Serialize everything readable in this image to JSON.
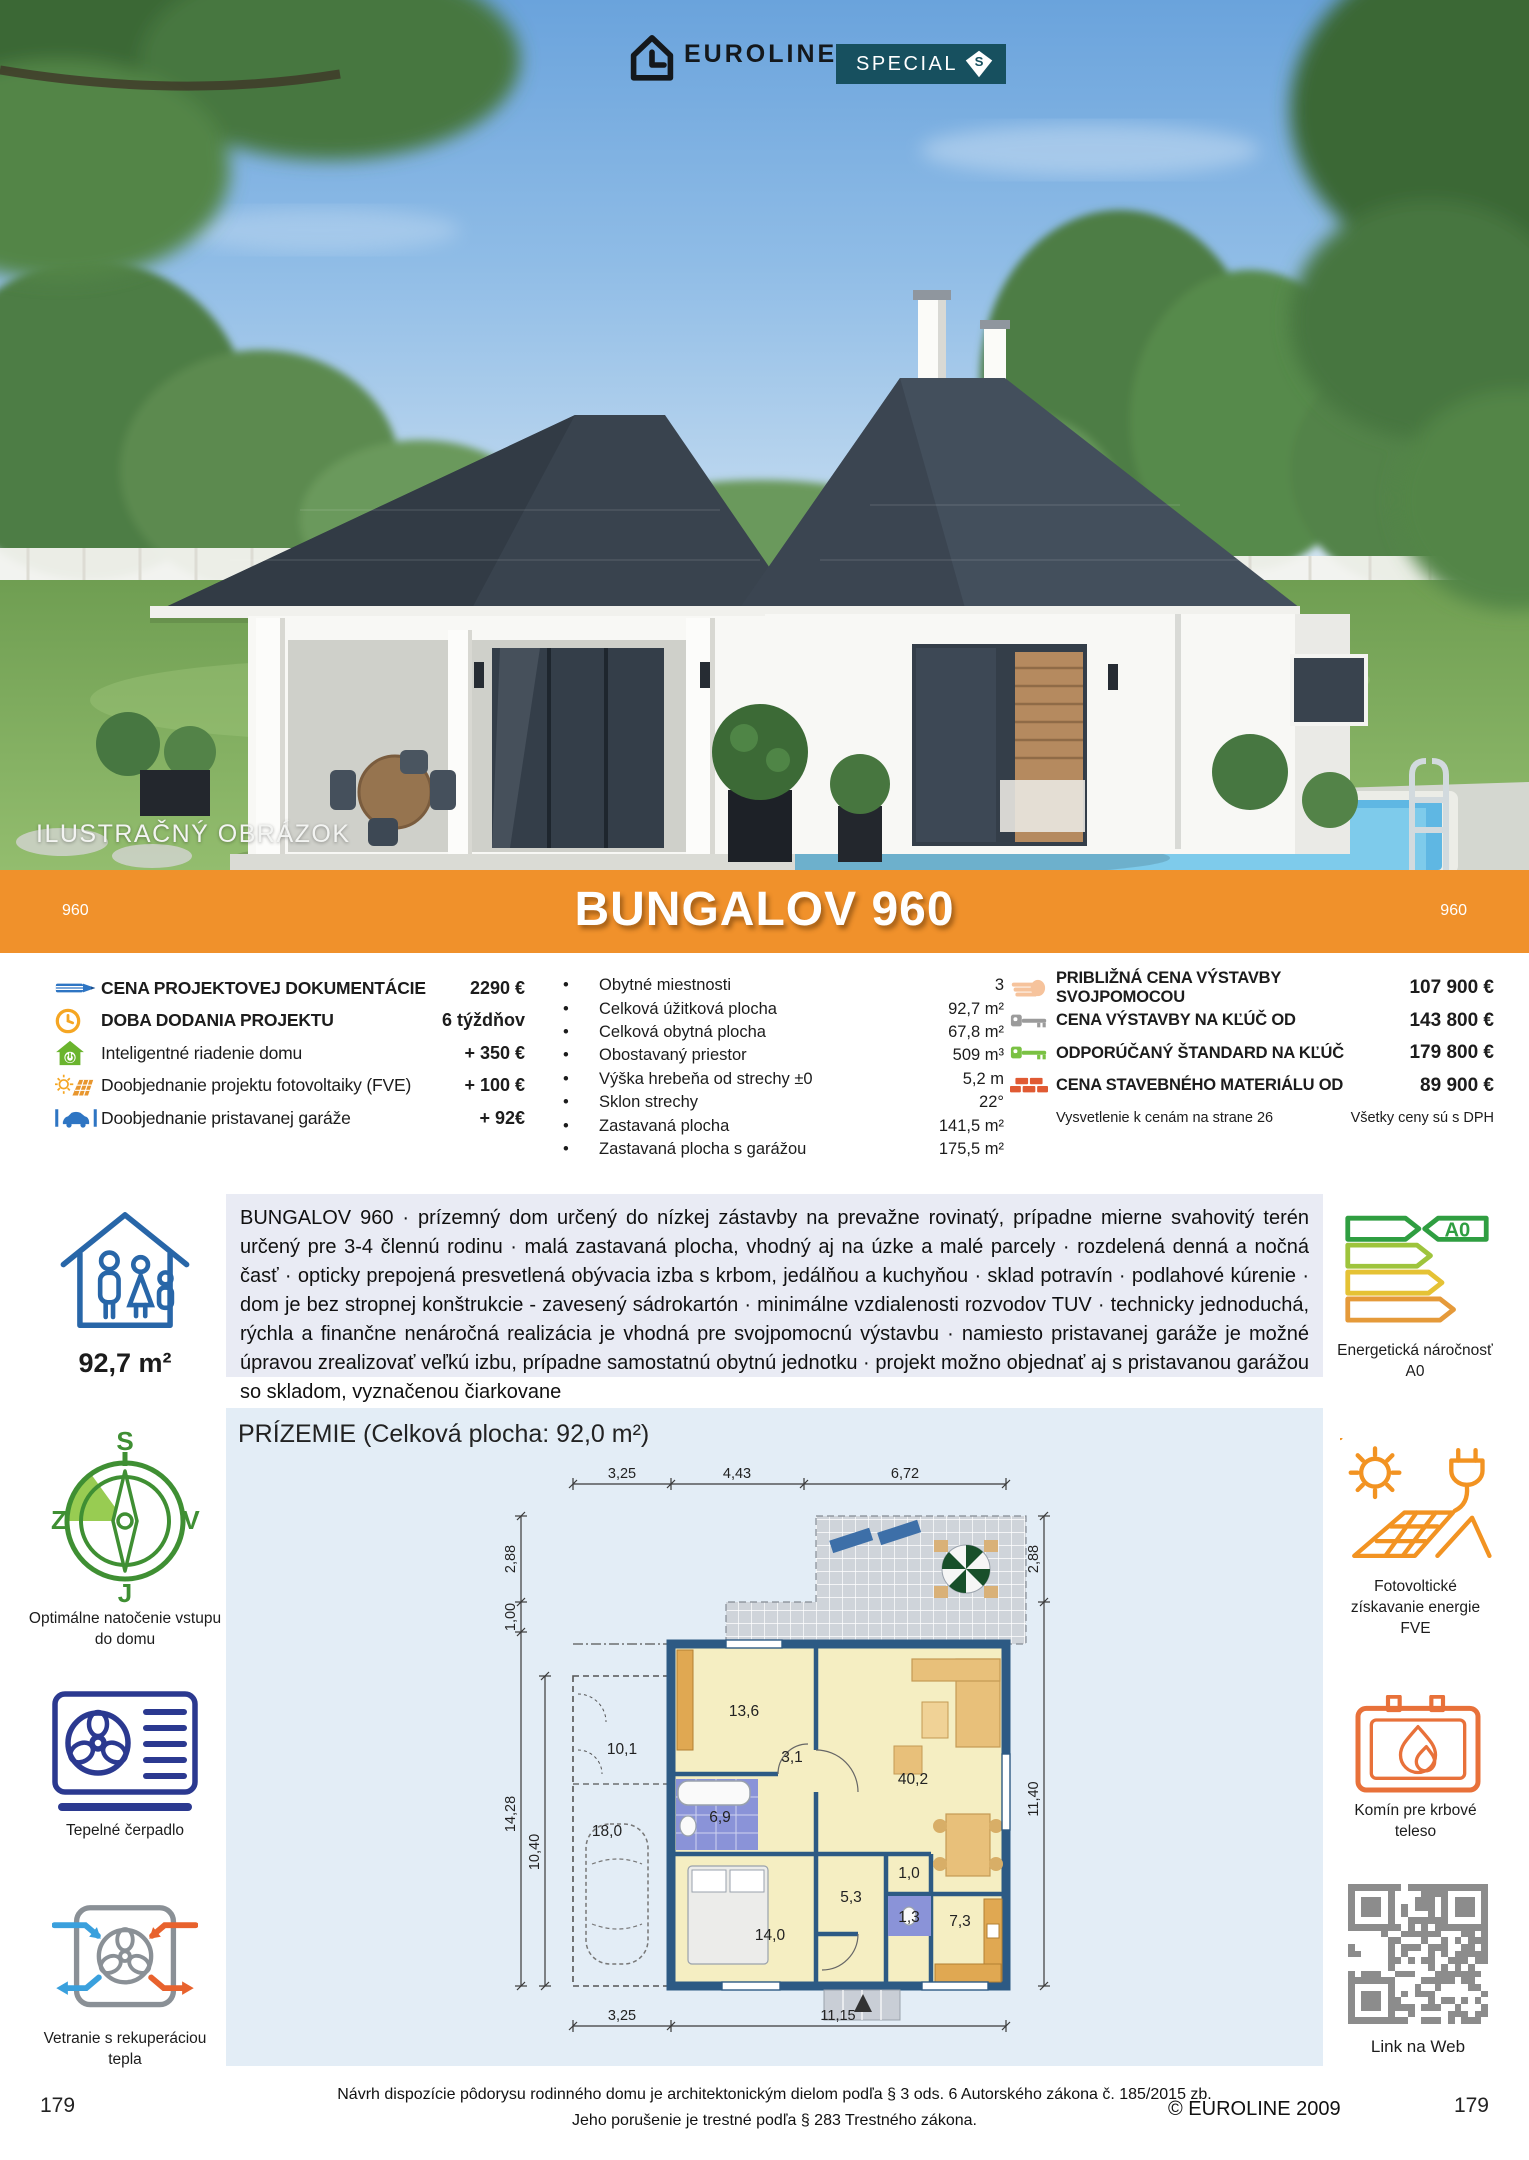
{
  "header": {
    "brand": "EUROLINE",
    "badge": "SPECIAL",
    "badge_letter": "S"
  },
  "photo": {
    "label": "ILUSTRAČNÝ OBRÁZOK"
  },
  "banner": {
    "code_left": "960",
    "title": "BUNGALOV 960",
    "code_right": "960"
  },
  "pricing_left": {
    "items": [
      {
        "icon": "pencil-icon",
        "label": "CENA PROJEKTOVEJ DOKUMENTÁCIE",
        "value": "2290 €"
      },
      {
        "icon": "clock-icon",
        "label": "DOBA DODANIA PROJEKTU",
        "value": "6 týždňov"
      },
      {
        "icon": "smart-home-icon",
        "label": "Inteligentné riadenie domu",
        "value": "+ 350 €"
      },
      {
        "icon": "solar-sun-icon",
        "label": "Doobjednanie projektu fotovoltaiky (FVE)",
        "value": "+ 100 €"
      },
      {
        "icon": "garage-car-icon",
        "label": "Doobjednanie pristavanej garáže",
        "value": "+ 92€"
      }
    ]
  },
  "specs": {
    "items": [
      {
        "label": "Obytné miestnosti",
        "value": "3"
      },
      {
        "label": "Celková úžitková plocha",
        "value": "92,7 m²"
      },
      {
        "label": "Celková obytná plocha",
        "value": "67,8 m²"
      },
      {
        "label": "Obostavaný priestor",
        "value": "509 m³"
      },
      {
        "label": "Výška hrebeňa od strechy ±0",
        "value": "5,2 m"
      },
      {
        "label": "Sklon strechy",
        "value": "22°"
      },
      {
        "label": "Zastavaná plocha",
        "value": "141,5 m²"
      },
      {
        "label": "Zastavaná plocha s garážou",
        "value": "175,5 m²"
      }
    ]
  },
  "pricing_right": {
    "items": [
      {
        "icon": "hand-icon",
        "label": "PRIBLIŽNÁ CENA VÝSTAVBY SVOJPOMOCOU",
        "value": "107 900 €"
      },
      {
        "icon": "key-gray-icon",
        "label": "CENA VÝSTAVBY NA KĽÚČ OD",
        "value": "143 800 €"
      },
      {
        "icon": "key-green-icon",
        "label": "ODPORÚČANÝ ŠTANDARD NA KĽÚČ",
        "value": "179 800 €"
      },
      {
        "icon": "bricks-icon",
        "label": "CENA STAVEBNÉHO MATERIÁLU OD",
        "value": "89 900 €"
      }
    ],
    "note_left": "Vysvetlenie k cenám na strane 26",
    "note_right": "Všetky ceny sú s DPH"
  },
  "description": {
    "text": "BUNGALOV 960 · prízemný dom určený do nízkej zástavby na prevažne rovinatý, prípadne mierne svahovitý terén určený pre 3-4 člennú rodinu · malá zastavaná plocha, vhodný aj na úzke a malé parcely · rozdelená denná a nočná časť · opticky prepojená presvetlená obývacia izba s krbom, jedálňou a kuchyňou · sklad potravín · podlahové kúrenie · dom je bez stropnej konštrukcie - zavesený sádrokartón · minimálne vzdialenosti rozvodov TUV · technicky jednoduchá, rýchla a finančne nenáročná realizácia je vhodná pre svojpomocnú výstavbu · namiesto pristavanej garáže je možné úpravou zrealizovať veľkú izbu, prípadne samostatnú obytnú jednotku · projekt možno objednať aj s pristavanou garážou so skladom, vyznačenou čiarkovane"
  },
  "sidebar_left": {
    "area": "92,7 m²",
    "compass": {
      "n": "S",
      "e": "V",
      "s": "J",
      "w": "Z"
    },
    "compass_label": "Optimálne natočenie vstupu do domu",
    "heat_pump_label": "Tepelné čerpadlo",
    "ventilation_label": "Vetranie s rekuperáciou tepla"
  },
  "sidebar_right": {
    "energy_class": "A0",
    "energy_label": "Energetická náročnosť A0",
    "pv_label": "Fotovoltické získavanie energie FVE",
    "chimney_label": "Komín pre krbové teleso",
    "qr_label": "Link na Web"
  },
  "plan": {
    "title": "PRÍZEMIE (Celková plocha: 92,0 m²)",
    "dims_top": [
      "3,25",
      "4,43",
      "6,72"
    ],
    "dims_bottom": [
      "3,25",
      "11,15"
    ],
    "dims_left": [
      "2,88",
      "1,00",
      "14,28",
      "10,40"
    ],
    "dims_right": [
      "2,88",
      "11,40"
    ],
    "rooms": {
      "r101": "10,1",
      "r180": "18,0",
      "r136": "13,6",
      "r69": "6,9",
      "r31": "3,1",
      "r140": "14,0",
      "r53": "5,3",
      "r10": "1,0",
      "r13": "1,3",
      "r73": "7,3",
      "r402": "40,2"
    }
  },
  "footer": {
    "line1": "Návrh dispozície pôdorysu rodinného domu je architektonickým dielom podľa § 3 ods. 6 Autorského zákona č. 185/2015 zb.",
    "line2": "Jeho porušenie je trestné podľa § 283 Trestného zákona.",
    "copyright": "© EUROLINE 2009",
    "page_left": "179",
    "page_right": "179"
  },
  "colors": {
    "accent_orange": "#f0912b",
    "badge_teal": "#17505f",
    "desc_bg": "#e9ebf4",
    "plan_bg": "#e3edf6",
    "plan_wall": "#2d5a84",
    "plan_floor": "#f5eec2",
    "plan_wet_room": "#8a93d8",
    "compass_green": "#3f8f33",
    "icon_blue": "#2866a8"
  }
}
